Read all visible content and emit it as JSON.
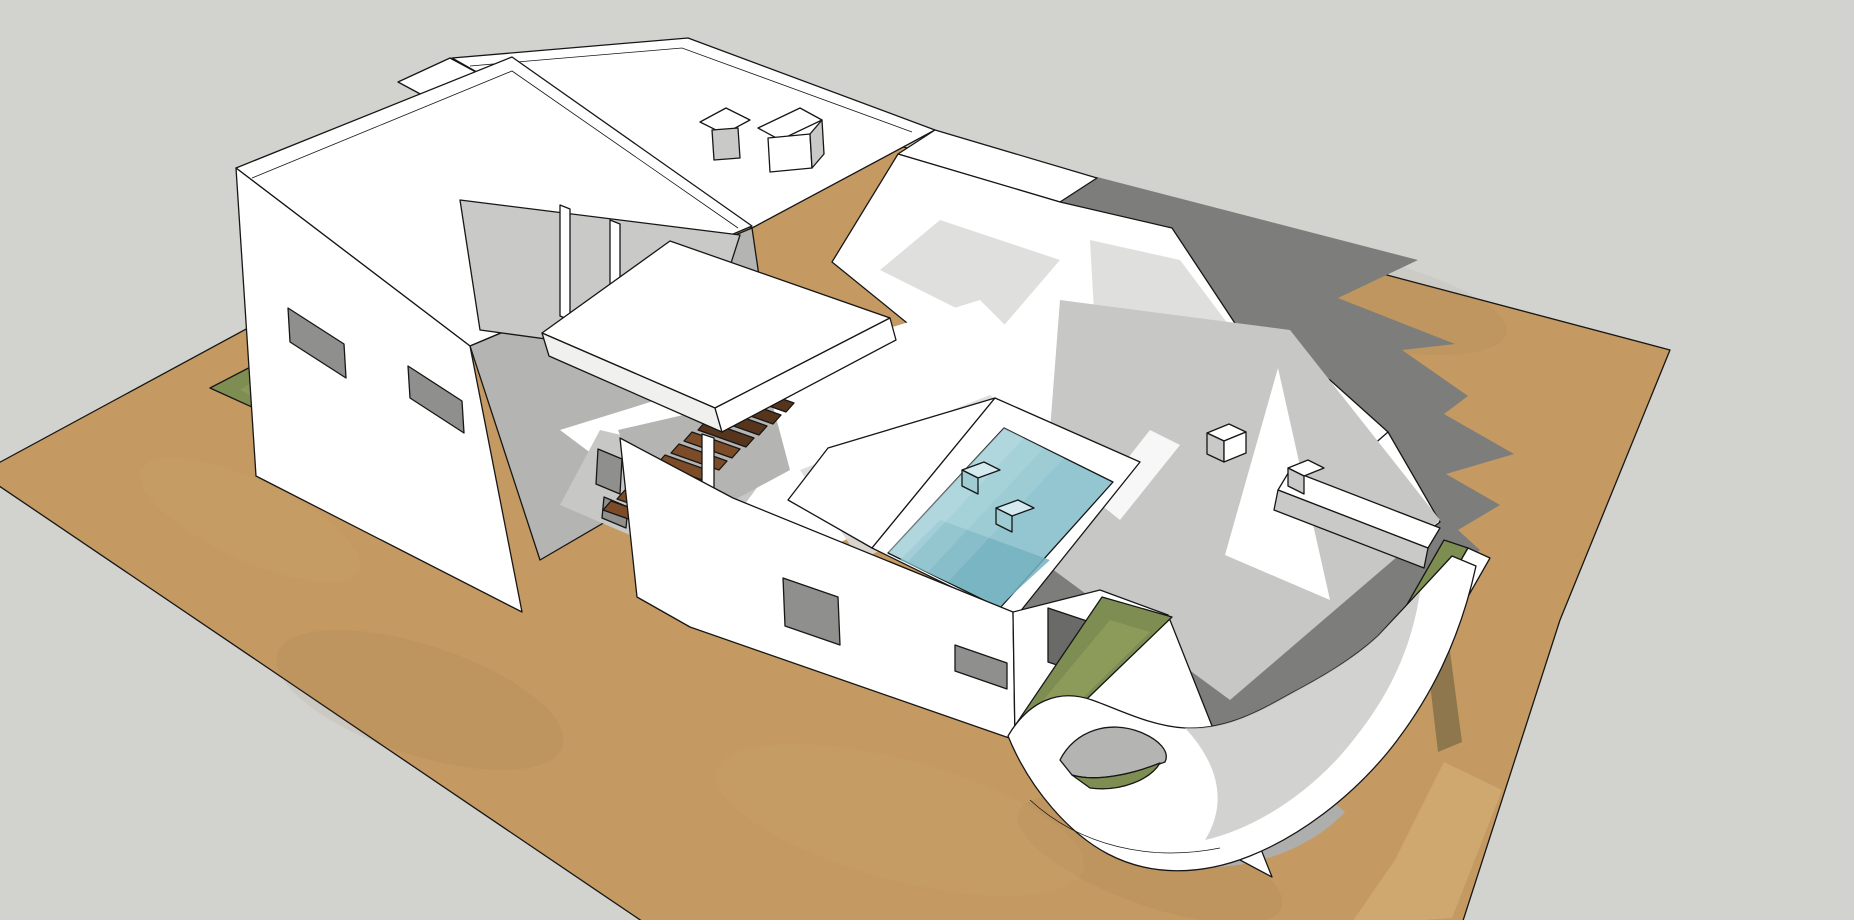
{
  "scene": {
    "type": "3d-architectural-model-render",
    "style": "sketchup-like edge render, flat white surfaces, hard cast shadows",
    "camera": "aerial three-quarter view from the south-west",
    "objects": [
      {
        "id": "site-plot",
        "label": "rectangular sand-colored site plot on plain gray ground"
      },
      {
        "id": "villa",
        "label": "white flat-roofed modern villa with parapet roof terraces"
      },
      {
        "id": "left-block",
        "label": "two-storey block with two facade windows and slot windows"
      },
      {
        "id": "upper-terrace",
        "label": "recessed upper terrace with thin columns"
      },
      {
        "id": "canopy-slab",
        "label": "floating flat canopy slab over the veranda"
      },
      {
        "id": "staircase",
        "label": "external wooden staircase with steel stringer beams"
      },
      {
        "id": "swimming-pool",
        "label": "sunken pool with entry steps and two cube stools"
      },
      {
        "id": "front-block",
        "label": "single-storey front block with window and slot window"
      },
      {
        "id": "right-terrace",
        "label": "walled garden terrace with long planter bench and cubes"
      },
      {
        "id": "curved-wall",
        "label": "sculptural curved white garden wall with organic opening"
      },
      {
        "id": "grass-beds",
        "label": "olive-green planting strips, lawn triangle and grass pocket"
      },
      {
        "id": "cast-shadow",
        "label": "hard-edged jagged shadow cast to the east of the house"
      },
      {
        "id": "roof-fixtures",
        "label": "rooftop chimneys, bench and edge railing"
      }
    ]
  },
  "colors": {
    "background": "#d2d2ce",
    "sand": "#c49a62",
    "sand_dark": "#8a6a3c",
    "sand_light": "#e2bf8a",
    "sand_path": "#d2ab74",
    "shadow_cast": "#7d7d7b",
    "shadow_band": "#85704a",
    "shadow_curve": "#aeaeac",
    "soft_shadow": "#c7c7c5",
    "softer_shadow": "#dcdcda",
    "white": "#ffffff",
    "white_dim": "#f0f0ee",
    "wall_shade": "#c9c9c7",
    "wall_shade_dark": "#b4b4b2",
    "window_gray": "#8f8f8d",
    "window_dark": "#6a6a68",
    "pool": "#93c6d0",
    "pool_deep": "#74b2bf",
    "pool_light": "#cde8ec",
    "pool_cube_top": "#d3eaee",
    "pool_cube_side": "#9fcbd3",
    "grass": "#7e8d51",
    "grass_light": "#a3b06a",
    "wood": "#7c4b27",
    "wood_dark": "#57351c",
    "steel": "#8a8a88",
    "line": "#161616"
  }
}
